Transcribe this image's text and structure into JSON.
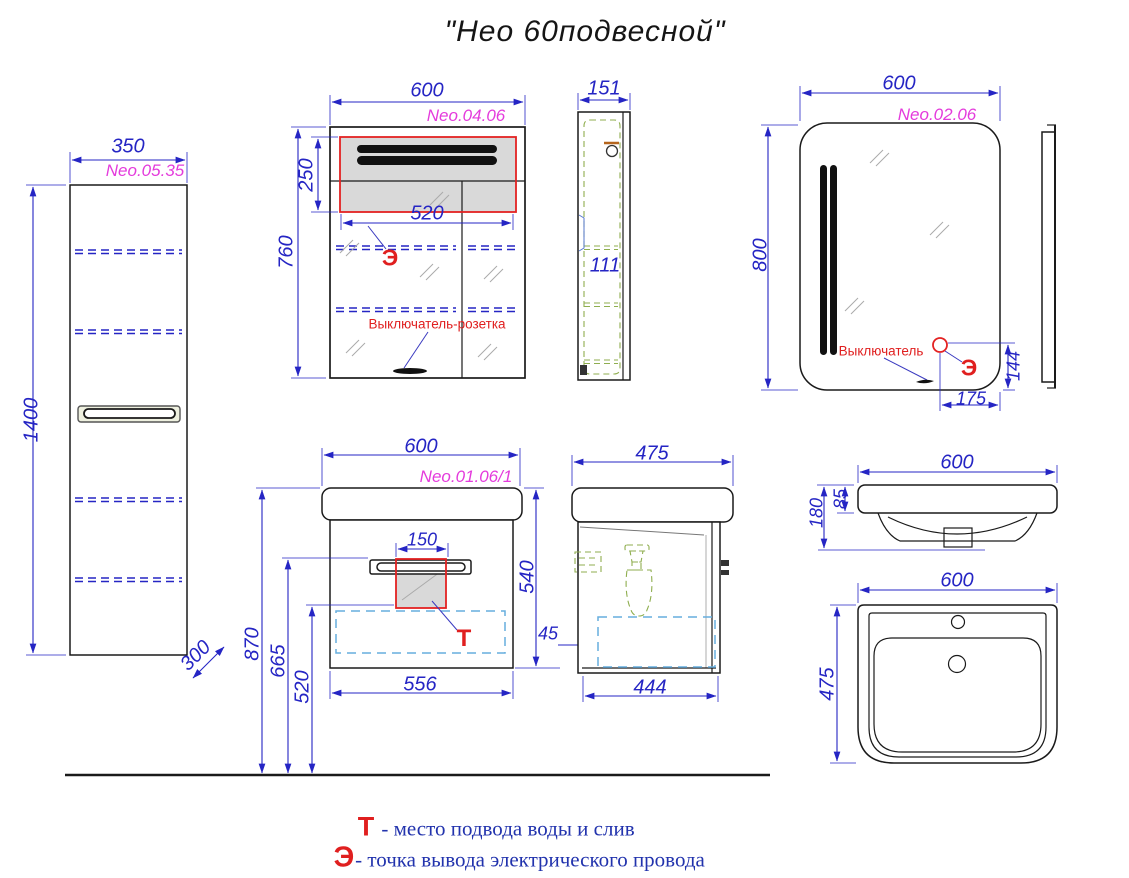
{
  "title": "\"Нео 60подвесной\"",
  "tall_cabinet": {
    "label": "Neo.05.35",
    "dim_width": "350",
    "dim_height": "1400",
    "dim_depth": "300"
  },
  "mirror_cabinet": {
    "label": "Neo.04.06",
    "dim_width": "600",
    "dim_height": "760",
    "dim_zone_height": "250",
    "dim_zone_width": "520",
    "marker_e": "Э",
    "note": "Выключатель-розетка",
    "side": {
      "dim_width": "151",
      "dim_inner": "111"
    }
  },
  "mirror": {
    "label": "Neo.02.06",
    "dim_width": "600",
    "dim_height": "800",
    "note": "Выключатель",
    "marker_e": "Э",
    "dim_switch_x": "175",
    "dim_switch_y": "144"
  },
  "vanity": {
    "label": "Neo.01.06/1",
    "dim_width": "600",
    "dim_height": "540",
    "dim_handle": "150",
    "dim_bottom_width": "556",
    "dim_floor_top": "870",
    "dim_floor_handle": "665",
    "dim_floor_drawer": "520",
    "dim_gap": "45",
    "marker_t": "Т",
    "side": {
      "dim_width": "475",
      "dim_bottom_width": "444"
    }
  },
  "sink": {
    "front": {
      "dim_width": "600",
      "dim_height": "180",
      "dim_rim": "85"
    },
    "top": {
      "dim_width": "600",
      "dim_depth": "475"
    }
  },
  "legend": {
    "t_marker": "Т",
    "t_text": "- место подвода воды и слив",
    "e_marker": "Э",
    "e_text": "- точка вывода электрического провода"
  },
  "colors": {
    "dimension": "#2525c4",
    "part_label": "#e43bdc",
    "marker": "#e01f1f",
    "shelf_dash": "#2525c4",
    "drawer_dash": "#67aede",
    "inner_dash": "#8fae4f",
    "zone_fill": "#d9d9d9"
  }
}
